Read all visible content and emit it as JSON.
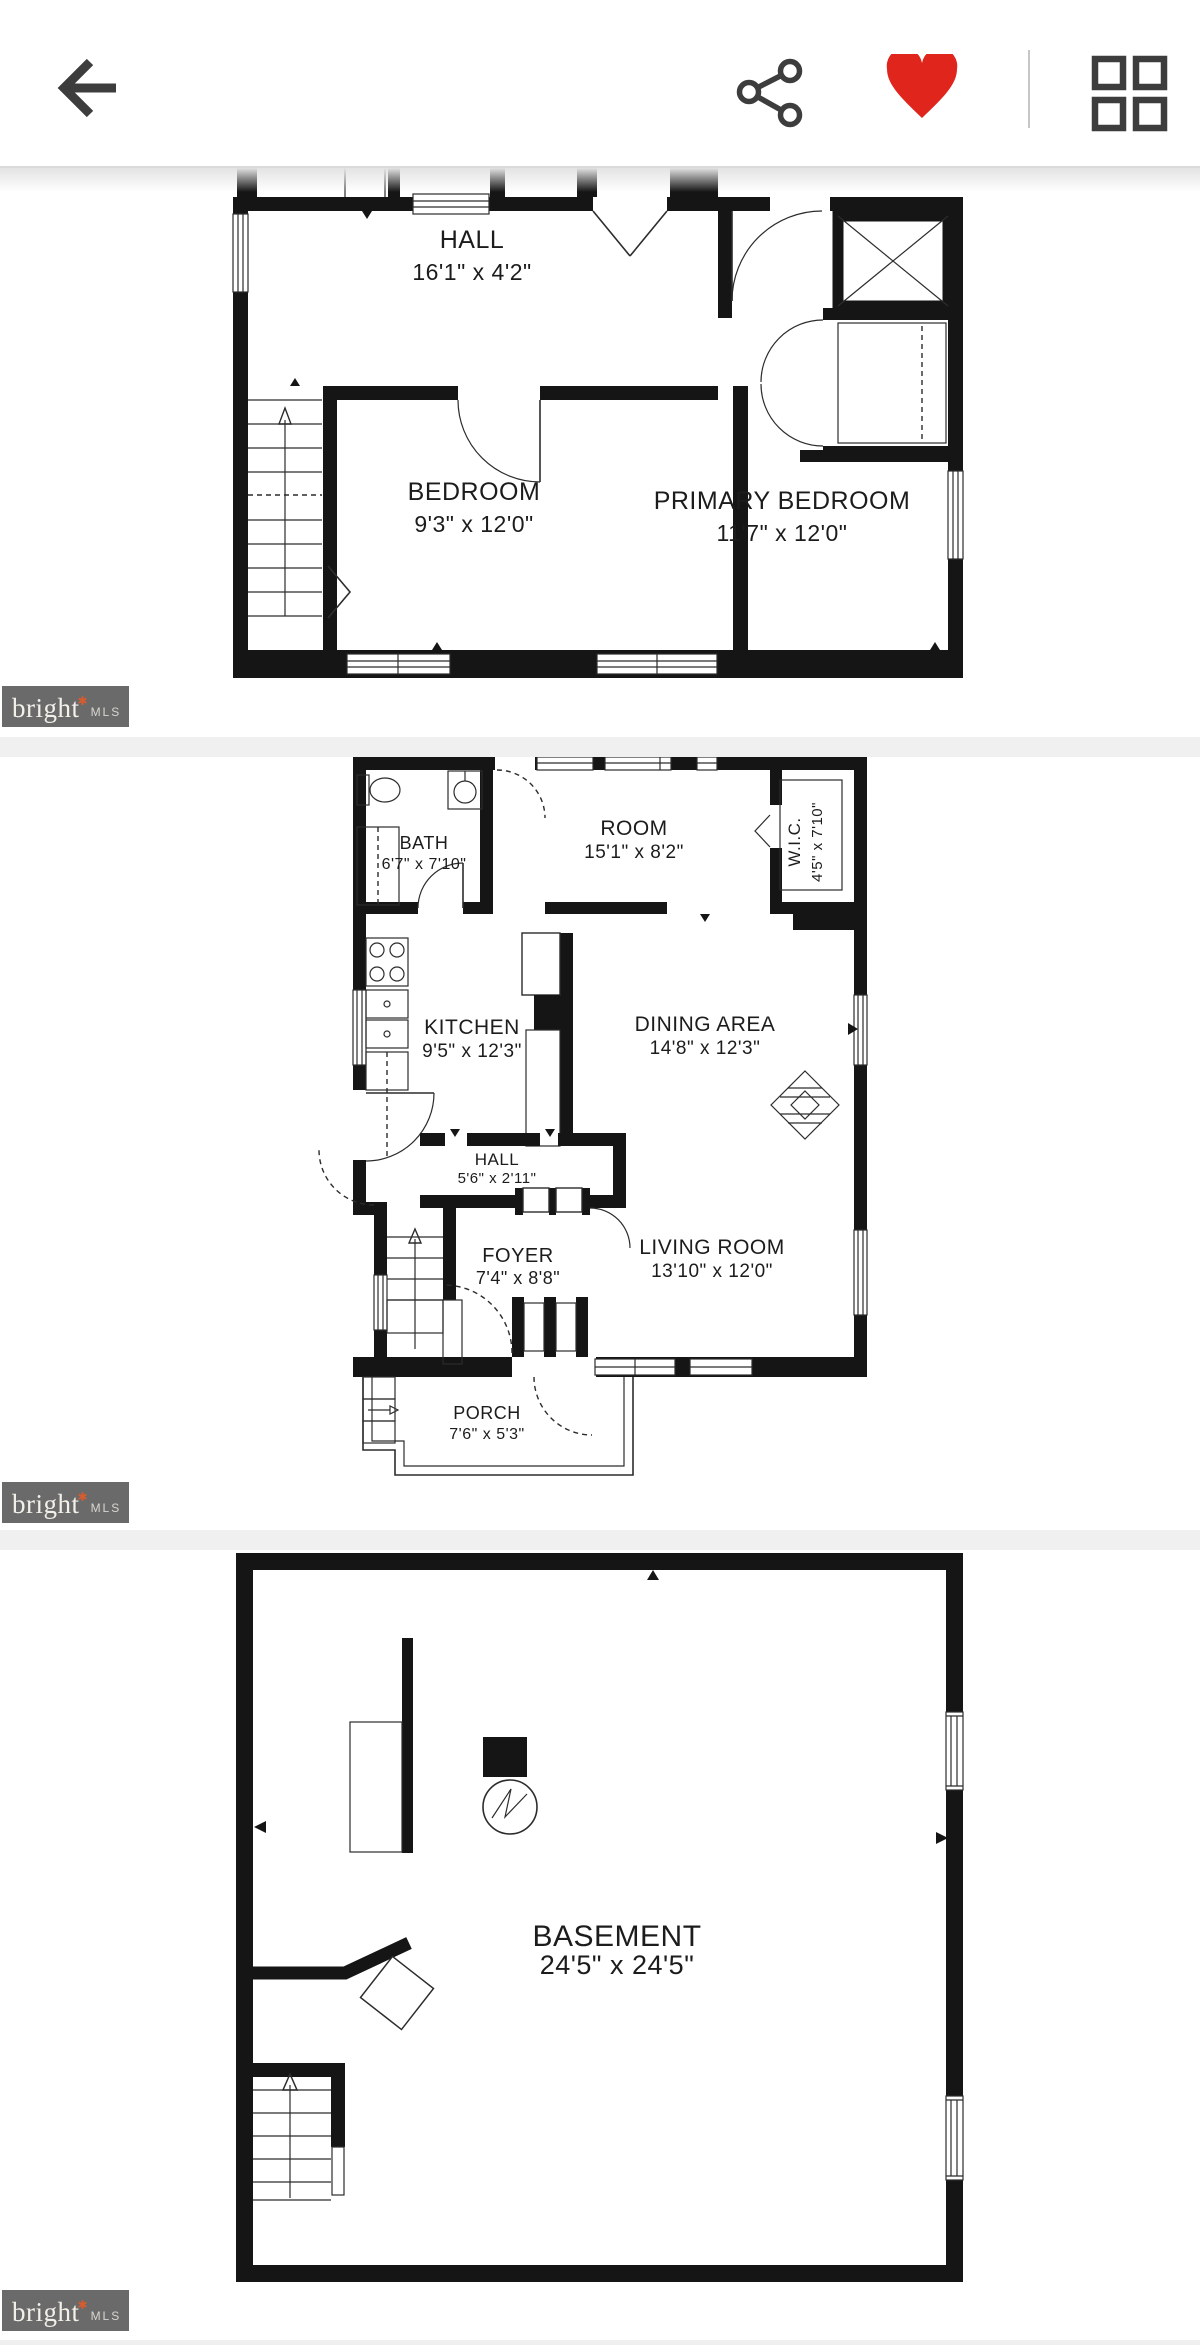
{
  "header": {
    "icons": {
      "back": "arrow-left",
      "share": "share-nodes",
      "favorite": "heart-filled",
      "gallery": "grid-2x2"
    }
  },
  "colors": {
    "favorite_red": "#e0251c",
    "icon_gray": "#3d3d3d",
    "watermark_bg": "#6a6a6a",
    "watermark_star": "#d95b2e"
  },
  "watermark": {
    "brand": "bright",
    "star": "✱",
    "suffix": "MLS"
  },
  "plans": [
    {
      "id": "upper-floor",
      "rooms": [
        {
          "name": "HALL",
          "dims": "16'1\" x 4'2\""
        },
        {
          "name": "BEDROOM",
          "dims": "9'3\" x 12'0\""
        },
        {
          "name": "PRIMARY BEDROOM",
          "dims": "11'7\" x 12'0\""
        }
      ]
    },
    {
      "id": "main-floor",
      "rooms": [
        {
          "name": "BATH",
          "dims": "6'7\" x 7'10\""
        },
        {
          "name": "ROOM",
          "dims": "15'1\" x 8'2\""
        },
        {
          "name": "W.I.C.",
          "dims": "4'5\" x 7'10\""
        },
        {
          "name": "KITCHEN",
          "dims": "9'5\" x 12'3\""
        },
        {
          "name": "DINING AREA",
          "dims": "14'8\" x 12'3\""
        },
        {
          "name": "HALL",
          "dims": "5'6\" x 2'11\""
        },
        {
          "name": "FOYER",
          "dims": "7'4\" x 8'8\""
        },
        {
          "name": "LIVING ROOM",
          "dims": "13'10\" x 12'0\""
        },
        {
          "name": "PORCH",
          "dims": "7'6\" x 5'3\""
        }
      ]
    },
    {
      "id": "basement",
      "rooms": [
        {
          "name": "BASEMENT",
          "dims": "24'5\" x 24'5\""
        }
      ]
    }
  ]
}
